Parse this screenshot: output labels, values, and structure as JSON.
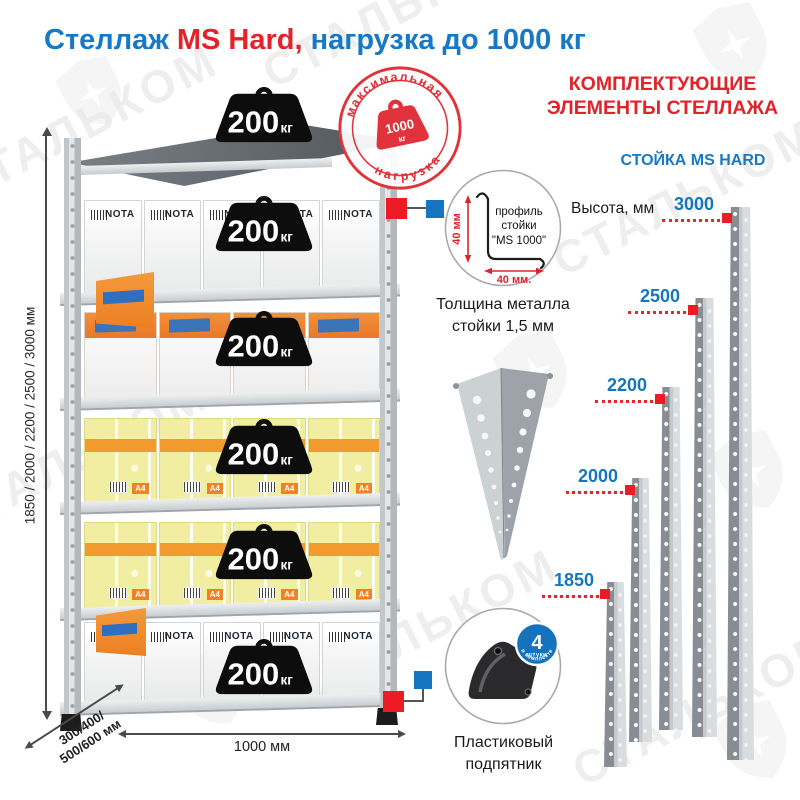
{
  "title": {
    "part1": "Стеллаж ",
    "part2": "MS Hard,",
    "part3": " нагрузка до 1000 кг"
  },
  "watermark": {
    "text": "СТАЛЬКОМ"
  },
  "stamp": {
    "arc_top": "максимальная",
    "arc_bottom": "нагрузка",
    "value": "1000",
    "unit": "кг"
  },
  "unit": {
    "weight_value": "200",
    "weight_unit": "кг",
    "box_brand": "NOTA",
    "box_a4": "A4",
    "dims": {
      "height": "1850 / 2000 / 2200 / 2500 / 3000 мм",
      "depth_line1": "300/400/",
      "depth_line2": "500/600 мм",
      "width": "1000 мм"
    }
  },
  "middle": {
    "profile": {
      "line1": "профиль",
      "line2": "стойки",
      "line3": "\"MS 1000\"",
      "dim_vertical": "40 мм",
      "dim_horizontal": "40 мм."
    },
    "thickness_line1": "Толщина металла",
    "thickness_line2": "стойки 1,5 мм",
    "foot_caption_line1": "Пластиковый",
    "foot_caption_line2": "подпятник",
    "badge": {
      "number": "4",
      "word1": "штуки",
      "word2": "в комплекте"
    }
  },
  "right": {
    "header_line1": "КОМПЛЕКТУЮЩИЕ",
    "header_line2": "ЭЛЕМЕНТЫ СТЕЛЛАЖА",
    "subheader": "СТОЙКА MS HARD",
    "height_label": "Высота, мм",
    "posts": [
      {
        "label": "3000"
      },
      {
        "label": "2500"
      },
      {
        "label": "2200"
      },
      {
        "label": "2000"
      },
      {
        "label": "1850"
      }
    ]
  },
  "colors": {
    "blue": "#1779c5",
    "red": "#e2232a",
    "marker_red": "#ed1c24",
    "marker_blue": "#1774c0",
    "badge_blue": "#1573bd"
  }
}
